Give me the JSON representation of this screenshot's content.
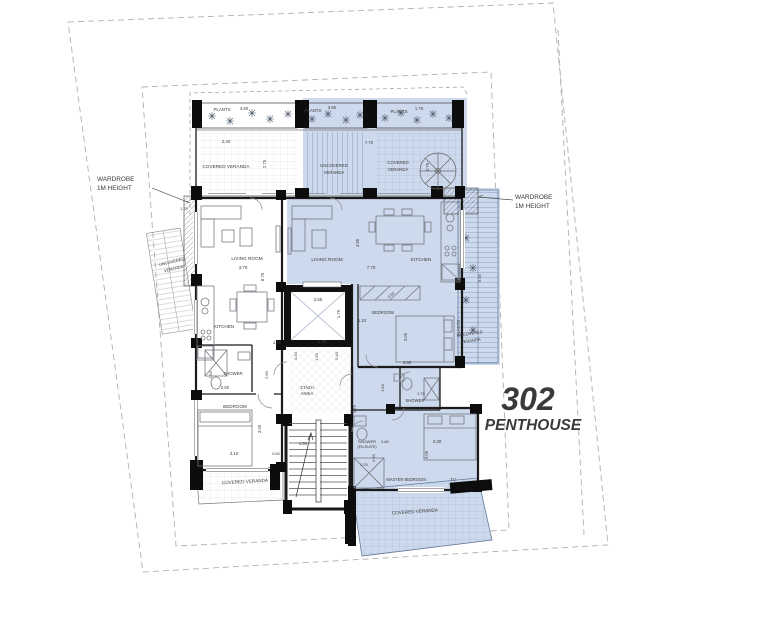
{
  "colors": {
    "accent": "#8b9fc2",
    "unit_highlight_fill": "#cdd9ec",
    "hatch_blue": "#41639b",
    "wall": "#1a1a1a",
    "boundary_dash": "#b0b0b0",
    "text": "#3a3a3a"
  },
  "unit": {
    "number": "302",
    "name": "PENTHOUSE"
  },
  "labels": [
    {
      "id": "wardrobe-left-line1",
      "t": "WARDROBE",
      "x": 97,
      "y": 181,
      "s": 6.4,
      "a": "start",
      "c": "#222222"
    },
    {
      "id": "wardrobe-left-line2",
      "t": "1M HEIGHT",
      "x": 97,
      "y": 190,
      "s": 6.4,
      "a": "start",
      "c": "#222222"
    },
    {
      "id": "wardrobe-right-line1",
      "t": "WARDROBE",
      "x": 515,
      "y": 199,
      "s": 6.4,
      "a": "start",
      "c": "#222222"
    },
    {
      "id": "wardrobe-right-line2",
      "t": "1M HEIGHT",
      "x": 515,
      "y": 208,
      "s": 6.4,
      "a": "start",
      "c": "#222222"
    },
    {
      "id": "plants-left",
      "t": "PLANTS",
      "x": 222,
      "y": 111,
      "s": 4.4
    },
    {
      "id": "plants-left-dim",
      "t": "3.60",
      "x": 244,
      "y": 110,
      "s": 4.2
    },
    {
      "id": "plants-mid",
      "t": "PLANTS",
      "x": 313,
      "y": 112,
      "s": 4.4
    },
    {
      "id": "plants-mid-dim",
      "t": "3.60",
      "x": 332,
      "y": 109,
      "s": 4.2
    },
    {
      "id": "plants-right",
      "t": "PLANTS",
      "x": 399,
      "y": 113,
      "s": 4.4
    },
    {
      "id": "plants-right-dim",
      "t": "1.75",
      "x": 419,
      "y": 110,
      "s": 4.2
    },
    {
      "id": "veranda-left-dim",
      "t": "2.40",
      "x": 226,
      "y": 143,
      "s": 4.4
    },
    {
      "id": "covered-veranda-left",
      "t": "COVERED VERANDA",
      "x": 226,
      "y": 168,
      "s": 4.7
    },
    {
      "id": "covered-veranda-left-vdim",
      "t": "2.75",
      "x": 266,
      "y": 164,
      "s": 4.2,
      "r": -90
    },
    {
      "id": "uncovered-veranda-mid-1",
      "t": "UNCOVERED",
      "x": 334,
      "y": 167,
      "s": 4.3
    },
    {
      "id": "uncovered-veranda-mid-2",
      "t": "VERANDA",
      "x": 334,
      "y": 174,
      "s": 4.3
    },
    {
      "id": "uncovered-veranda-mid-dim",
      "t": "7.70",
      "x": 369,
      "y": 144,
      "s": 4.2
    },
    {
      "id": "covered-veranda-right-1",
      "t": "COVERED",
      "x": 398,
      "y": 164,
      "s": 4.3
    },
    {
      "id": "covered-veranda-right-2",
      "t": "VERANDA",
      "x": 398,
      "y": 171,
      "s": 4.3
    },
    {
      "id": "covered-veranda-right-vdim",
      "t": "2.75",
      "x": 429,
      "y": 167,
      "s": 4.2,
      "r": -90
    },
    {
      "id": "wardrobe-left-dim",
      "t": "1.70",
      "x": 184,
      "y": 210,
      "s": 4
    },
    {
      "id": "uncovered-veranda-left-1",
      "t": "UNCOVERED",
      "x": 172,
      "y": 263,
      "s": 4.1,
      "r": -14
    },
    {
      "id": "uncovered-veranda-left-2",
      "t": "VERANDA",
      "x": 174,
      "y": 270,
      "s": 4.1,
      "r": -14
    },
    {
      "id": "living-room-left",
      "t": "LIVING ROOM",
      "x": 247,
      "y": 260,
      "s": 4.7
    },
    {
      "id": "living-room-left-dim",
      "t": "3.70",
      "x": 243,
      "y": 269,
      "s": 4.4
    },
    {
      "id": "living-room-left-vdim",
      "t": "8.75",
      "x": 264,
      "y": 277,
      "s": 4.2,
      "r": -90
    },
    {
      "id": "living-room-right",
      "t": "LIVING ROOM",
      "x": 327,
      "y": 261,
      "s": 4.7
    },
    {
      "id": "living-room-right-dim",
      "t": "7.70",
      "x": 371,
      "y": 269,
      "s": 4.4
    },
    {
      "id": "living-room-right-vdim",
      "t": "3.95",
      "x": 359,
      "y": 243,
      "s": 4.2,
      "r": -90
    },
    {
      "id": "kitchen-right",
      "t": "KITCHEN",
      "x": 421,
      "y": 261,
      "s": 4.7
    },
    {
      "id": "elevator-dim-w",
      "t": "2.55",
      "x": 318,
      "y": 301,
      "s": 4.4
    },
    {
      "id": "elevator-dim-h",
      "t": "1.75",
      "x": 340,
      "y": 314,
      "s": 4.2,
      "r": -90
    },
    {
      "id": "hall-dim-right",
      "t": "1.10",
      "x": 362,
      "y": 322,
      "s": 4.2
    },
    {
      "id": "hall-dim-1",
      "t": "2.00",
      "x": 322,
      "y": 343,
      "s": 4.2
    },
    {
      "id": "hall-dim-2",
      "t": "0.40",
      "x": 297,
      "y": 356,
      "s": 4,
      "r": -90
    },
    {
      "id": "hall-dim-3",
      "t": "1.50",
      "x": 318,
      "y": 357,
      "s": 4,
      "r": -90
    },
    {
      "id": "hall-dim-4",
      "t": "0.40",
      "x": 338,
      "y": 356,
      "s": 4,
      "r": -90
    },
    {
      "id": "hall-dim-5",
      "t": "1.65",
      "x": 277,
      "y": 344,
      "s": 4.2
    },
    {
      "id": "hall-dim-6",
      "t": "2.60",
      "x": 268,
      "y": 375,
      "s": 4,
      "r": -90
    },
    {
      "id": "kitchen-left",
      "t": "KITCHEN",
      "x": 224,
      "y": 328,
      "s": 4.7
    },
    {
      "id": "shower-left",
      "t": "SHOWER",
      "x": 233,
      "y": 375,
      "s": 4.3
    },
    {
      "id": "shower-left-dim",
      "t": "2.50",
      "x": 225,
      "y": 389,
      "s": 4.2
    },
    {
      "id": "shower-left-vdim",
      "t": "1.50",
      "x": 212,
      "y": 375,
      "s": 4,
      "r": -90
    },
    {
      "id": "bedroom-left",
      "t": "BEDROOM",
      "x": 235,
      "y": 408,
      "s": 4.6
    },
    {
      "id": "bedroom-left-dim",
      "t": "3.10",
      "x": 234,
      "y": 455,
      "s": 4.4
    },
    {
      "id": "bedroom-left-vdim",
      "t": "3.00",
      "x": 261,
      "y": 429,
      "s": 4.2,
      "r": -90
    },
    {
      "id": "bedroom-left-dim2",
      "t": "0.60",
      "x": 276,
      "y": 455,
      "s": 4
    },
    {
      "id": "covered-veranda-bl",
      "t": "COVERED VERANDA",
      "x": 245,
      "y": 483,
      "s": 4.6,
      "r": -3
    },
    {
      "id": "stair-area-1",
      "t": "ΣΤΑΣΗ",
      "x": 307,
      "y": 389,
      "s": 4.2
    },
    {
      "id": "stair-area-2",
      "t": "ΑΝΙΚΑ",
      "x": 307,
      "y": 395,
      "s": 4.2
    },
    {
      "id": "stairs-dim",
      "t": "1.50",
      "x": 303,
      "y": 445,
      "s": 4.2
    },
    {
      "id": "bedroom-right",
      "t": "BEDROOM",
      "x": 383,
      "y": 314,
      "s": 4.2
    },
    {
      "id": "bedroom-right-vdim",
      "t": "3.05",
      "x": 407,
      "y": 337,
      "s": 4.2,
      "r": -90
    },
    {
      "id": "bedroom-right-dim",
      "t": "3.80",
      "x": 407,
      "y": 364,
      "s": 4.4
    },
    {
      "id": "bedroom-right-dim2",
      "t": "0.90",
      "x": 392,
      "y": 296,
      "s": 3.8,
      "r": -40
    },
    {
      "id": "shower-right",
      "t": "SHOWER",
      "x": 415,
      "y": 402,
      "s": 4.3
    },
    {
      "id": "shower-right-dim",
      "t": "1.75",
      "x": 421,
      "y": 395,
      "s": 4
    },
    {
      "id": "shower-right-vdim",
      "t": "1.50",
      "x": 384,
      "y": 388,
      "s": 4,
      "r": -90
    },
    {
      "id": "shower-right-vdim2",
      "t": "0.75",
      "x": 356,
      "y": 409,
      "s": 4,
      "r": -90
    },
    {
      "id": "ensuite-1",
      "t": "SHOWER",
      "x": 367,
      "y": 443,
      "s": 4
    },
    {
      "id": "ensuite-2",
      "t": "(EN-SUITE)",
      "x": 367,
      "y": 448,
      "s": 3.6
    },
    {
      "id": "ensuite-dim1",
      "t": "0.60",
      "x": 385,
      "y": 443,
      "s": 4
    },
    {
      "id": "ensuite-vdim",
      "t": "3.50",
      "x": 375,
      "y": 458,
      "s": 4,
      "r": -90
    },
    {
      "id": "ensuite-dim2",
      "t": "1.20",
      "x": 364,
      "y": 466,
      "s": 4
    },
    {
      "id": "master-bedroom",
      "t": "MASTER BEDROOM",
      "x": 406,
      "y": 481,
      "s": 4.1
    },
    {
      "id": "master-tv",
      "t": "TV",
      "x": 453,
      "y": 481,
      "s": 4.4
    },
    {
      "id": "master-dim",
      "t": "3.30",
      "x": 437,
      "y": 443,
      "s": 4.4
    },
    {
      "id": "master-vdim",
      "t": "3.05",
      "x": 428,
      "y": 455,
      "s": 4.2,
      "r": -90
    },
    {
      "id": "covered-veranda-br",
      "t": "COVERED VERANDA",
      "x": 415,
      "y": 513,
      "s": 4.6,
      "r": -4
    },
    {
      "id": "plants-right-strip",
      "t": "PLANTS",
      "x": 460,
      "y": 328,
      "s": 4.2,
      "r": -90
    },
    {
      "id": "uncovered-veranda-right-1",
      "t": "UNCOVERED",
      "x": 470,
      "y": 335,
      "s": 4.1,
      "r": -8
    },
    {
      "id": "uncovered-veranda-right-2",
      "t": "VERANDA",
      "x": 471,
      "y": 342,
      "s": 4.1,
      "r": -8
    },
    {
      "id": "right-strip-vdim",
      "t": "6.65",
      "x": 481,
      "y": 278,
      "s": 4,
      "r": -90
    },
    {
      "id": "unit-number",
      "t": "302",
      "x": 528,
      "y": 410,
      "s": 32,
      "b": 1,
      "i": 1,
      "c": "accent"
    },
    {
      "id": "unit-name",
      "t": "PENTHOUSE",
      "x": 533,
      "y": 430,
      "s": 15.5,
      "b": 1,
      "i": 1,
      "c": "accent"
    }
  ]
}
